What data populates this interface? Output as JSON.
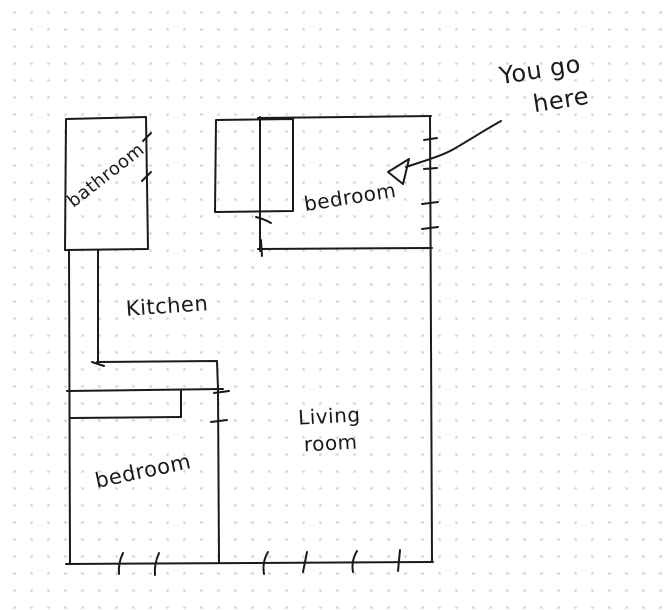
{
  "canvas": {
    "background": "#ffffff",
    "dot_grid_color": "#d7d7d7",
    "ink_color": "#1a1a1a"
  },
  "labels": {
    "bathroom": "bathroom",
    "kitchen": "Kitchen",
    "bedroom_top": "bedroom",
    "living_room_line1": "Living",
    "living_room_line2": "room",
    "bedroom_bottom": "bedroom",
    "annotation_line1": "You go",
    "annotation_line2": "here"
  }
}
